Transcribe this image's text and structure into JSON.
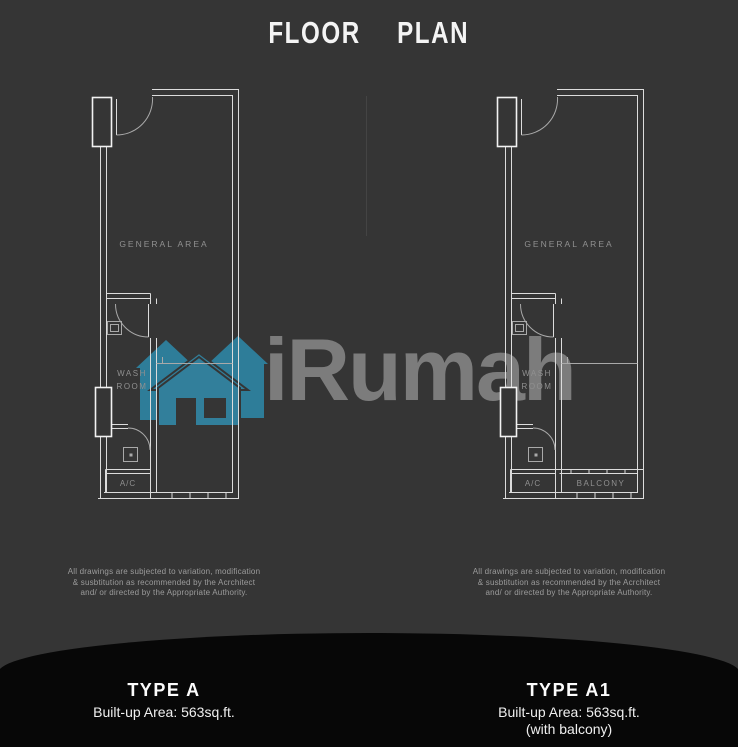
{
  "title": "FLOOR PLAN",
  "watermark": {
    "brand": "iRumah"
  },
  "plans": [
    {
      "name": "TYPE A",
      "area": "Built-up Area: 563sq.ft.",
      "note": "",
      "labels": {
        "general_area": "GENERAL AREA",
        "wash_room_line1": "WASH",
        "wash_room_line2": "ROOM",
        "ac": "A/C"
      },
      "disclaimer": [
        "All drawings are subjected to variation, modification",
        "& susbtitution as recommended by the Acrchitect",
        "and/ or directed by the Appropriate Authority."
      ]
    },
    {
      "name": "TYPE A1",
      "area": "Built-up Area: 563sq.ft.",
      "note": "(with balcony)",
      "labels": {
        "general_area": "GENERAL AREA",
        "wash_room_line1": "WASH",
        "wash_room_line2": "ROOM",
        "ac": "A/C",
        "balcony": "BALCONY"
      },
      "disclaimer": [
        "All drawings are subjected to variation, modification",
        "& susbtitution as recommended by the Acrchitect",
        "and/ or directed by the Appropriate Authority."
      ]
    }
  ],
  "colors": {
    "background": "#353535",
    "wall_bright": "#dcdcdc",
    "wall_dim": "#a9a9a9",
    "room_label": "#909090",
    "logo_teal": "#2e7d99",
    "brand_gray": "#7c7c7c",
    "footer_black": "#070707"
  }
}
